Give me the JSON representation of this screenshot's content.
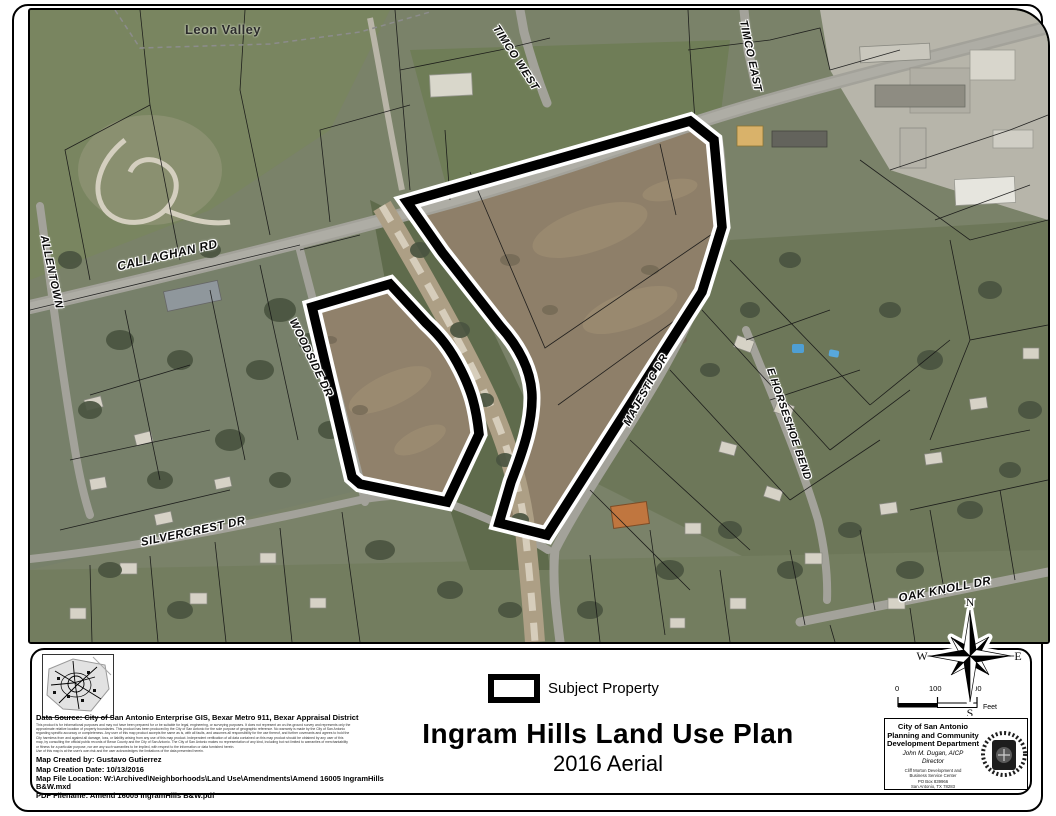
{
  "map": {
    "place_label": "Leon Valley",
    "streets": {
      "timco_west": "TIMCO WEST",
      "timco_east": "TIMCO EAST",
      "callaghan": "CALLAGHAN RD",
      "allentown": "ALLENTOWN",
      "woodside": "WOODSIDE DR",
      "majestic": "MAJESTIC DR",
      "horseshoe": "E HORSESHOE BEND",
      "silvercrest": "SILVERCREST DR",
      "oakknoll": "OAK KNOLL DR"
    }
  },
  "legend": {
    "subject_property_label": "Subject Property"
  },
  "title": {
    "main": "Ingram Hills Land Use Plan",
    "subtitle": "2016 Aerial"
  },
  "compass": {
    "n": "N",
    "s": "S",
    "e": "E",
    "w": "W"
  },
  "scalebar": {
    "ticks": [
      "0",
      "100",
      "200"
    ],
    "unit": "Feet"
  },
  "credits": {
    "data_source": "Data Source: City of San Antonio Enterprise GIS, Bexar Metro 911, Bexar Appraisal District",
    "disclaimer_lines": [
      "This product is for informational purposes and may not have been prepared for or be suitable for legal, engineering, or surveying purposes. It does not represent an on-the-ground survey and represents only the",
      "approximate relative location of property boundaries. This product has been produced by the City of San Antonio for the sole purpose of geographic reference. No warranty is made by the City of San Antonio",
      "regarding specific accuracy or completeness. Any user of this map product accepts the same as is, with all faults, and assumes all responsibility for the use thereof, and further covenants and agrees to hold the",
      "City harmless from and against all damage, loss, or liability arising from any use of this map product. Independent verification of all data contained on this map product should be obtained by any user of this",
      "map, by consulting the official public records of Bexar County and the City of San Antonio. The City of San Antonio makes no representation of any kind, including but not limited to warranties of merchantability",
      "or fitness for a particular purpose, nor are any such warranties to be implied, with respect to the information or data furnished herein.",
      "Use of this map is at the user's own risk and the user acknowledges the limitations of the data presented herein."
    ],
    "created_by": "Map Created by: Gustavo Gutierrez",
    "creation_date": "Map Creation Date: 10/13/2016",
    "file_location": "Map File Location: W:\\Archived\\Neighborhoods\\Land Use\\Amendments\\Amend 16005 IngramHills B&W.mxd",
    "pdf_filename": "PDF Filename: Amend 16005 IngramHills B&W.pdf"
  },
  "department": {
    "line1": "City of San Antonio",
    "line2": "Planning and Community",
    "line3": "Development Department",
    "director_name": "John M. Dugan, AICP",
    "director_title": "Director",
    "address_lines": [
      "Cliff Morton Development and",
      "Business Service Center",
      "PO Box 839966",
      "San Antonio, TX 78283"
    ]
  },
  "colors": {
    "subject_outline": "#000000",
    "subject_casing": "#ffffff",
    "aerial_base": "#7a8269",
    "aerial_field": "#8e7f69",
    "road": "#a3a29a"
  }
}
